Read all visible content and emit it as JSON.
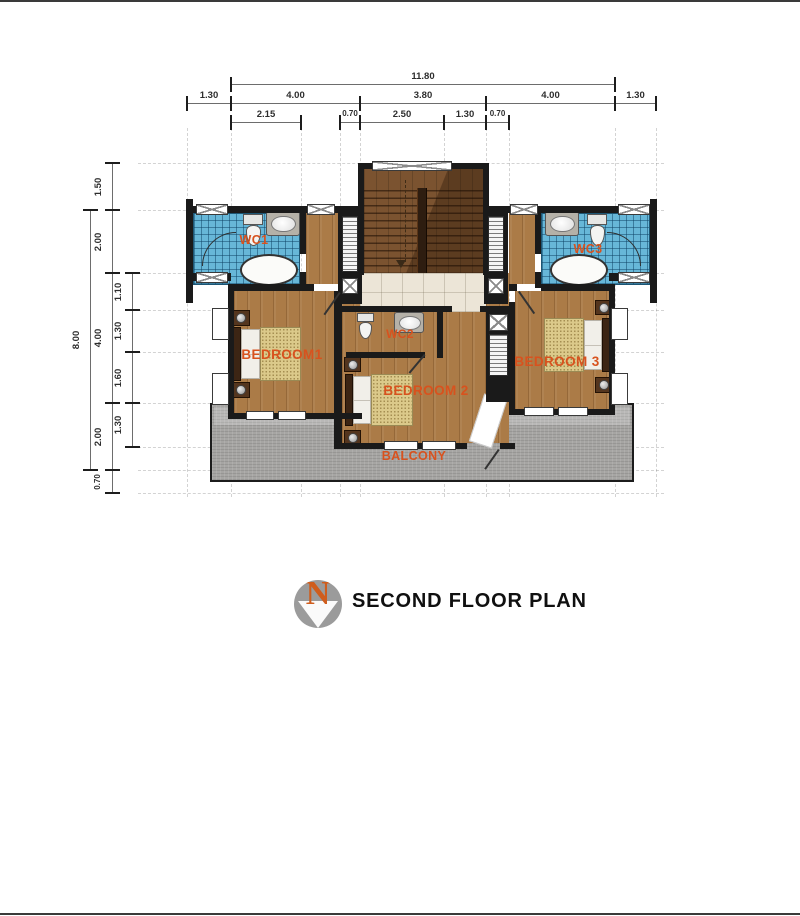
{
  "title_block": {
    "title": "SECOND FLOOR PLAN",
    "compass_letter": "N"
  },
  "rooms": {
    "wc1": "WC1",
    "wc2": "WC2",
    "wc3": "WC3",
    "bedroom1": "BEDROOM1",
    "bedroom2": "BEDROOM 2",
    "bedroom3": "BEDROOM 3",
    "balcony": "BALCONY"
  },
  "dimensions": {
    "horizontal": [
      {
        "t": "11.80",
        "x1": 231,
        "x2": 615,
        "y": 84
      },
      {
        "t": "1.30",
        "x1": 187,
        "x2": 231,
        "y": 103
      },
      {
        "t": "4.00",
        "x1": 231,
        "x2": 360,
        "y": 103
      },
      {
        "t": "3.80",
        "x1": 360,
        "x2": 486,
        "y": 103
      },
      {
        "t": "4.00",
        "x1": 486,
        "x2": 615,
        "y": 103
      },
      {
        "t": "1.30",
        "x1": 615,
        "x2": 656,
        "y": 103
      },
      {
        "t": "2.15",
        "x1": 231,
        "x2": 301,
        "y": 122
      },
      {
        "t": "0.70",
        "x1": 340,
        "x2": 360,
        "y": 122,
        "s": 1
      },
      {
        "t": "2.50",
        "x1": 360,
        "x2": 444,
        "y": 122
      },
      {
        "t": "1.30",
        "x1": 444,
        "x2": 486,
        "y": 122
      },
      {
        "t": "0.70",
        "x1": 486,
        "x2": 509,
        "y": 122,
        "s": 1
      }
    ],
    "vertical": [
      {
        "t": "8.00",
        "y1": 210,
        "y2": 470,
        "x": 90
      },
      {
        "t": "1.50",
        "y1": 163,
        "y2": 210,
        "x": 112
      },
      {
        "t": "2.00",
        "y1": 210,
        "y2": 273,
        "x": 112
      },
      {
        "t": "4.00",
        "y1": 273,
        "y2": 403,
        "x": 112
      },
      {
        "t": "2.00",
        "y1": 403,
        "y2": 470,
        "x": 112
      },
      {
        "t": "0.70",
        "y1": 470,
        "y2": 493,
        "x": 112,
        "s": 1
      },
      {
        "t": "1.10",
        "y1": 273,
        "y2": 310,
        "x": 132
      },
      {
        "t": "1.30",
        "y1": 310,
        "y2": 352,
        "x": 132
      },
      {
        "t": "1.60",
        "y1": 352,
        "y2": 403,
        "x": 132
      },
      {
        "t": "1.30",
        "y1": 403,
        "y2": 447,
        "x": 132
      }
    ]
  },
  "colors": {
    "wall": "#1a1a1a",
    "wood": "#ab7b47",
    "stair_wood": "#7b5330",
    "tile_blue": "#67b7d8",
    "landing": "#ece5d7",
    "balcony": "#a6a5a3",
    "label": "#d8521e",
    "dim_text": "#2d2d2d",
    "compass_gray": "#9b9b9b",
    "compass_n": "#cf5d1d"
  }
}
